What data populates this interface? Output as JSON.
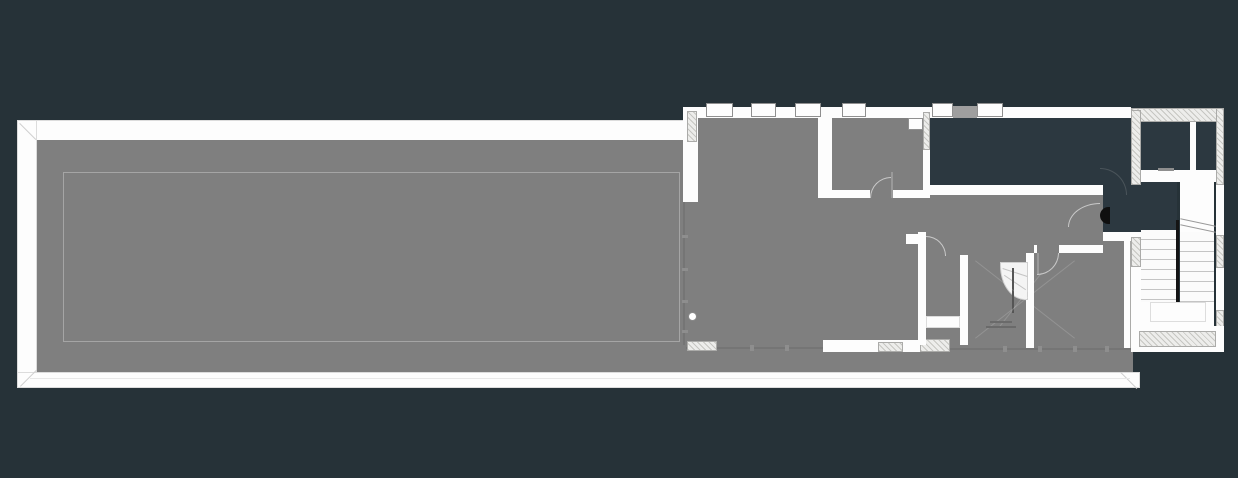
{
  "scene": {
    "type": "architectural floor plan on dark canvas",
    "visible_text": ""
  },
  "colors": {
    "background": "#263238",
    "void": "#2c3840",
    "floor": "#7f7f7f",
    "wall": "#fdfdfd",
    "wall_outline": "#dcdcdc",
    "inner_outline": "#a5a5a5",
    "hatch_fill": "#ededeb",
    "hatch_line": "#c6c6c2",
    "thin_line": "#757575",
    "tread_line": "#c4c4c4",
    "door_arc_light": "#c9c9c9",
    "door_arc_dark": "#4a545a",
    "door_leaf_black": "#0f0f0f",
    "pier_gray": "#9e9e9e"
  },
  "features": [
    "garden-roof-terrace",
    "perimeter-wall",
    "lawn-inner-outline",
    "living-room",
    "bedroom",
    "bathroom",
    "south-east-room",
    "courtyard-void",
    "entry-corridor",
    "top-right-room",
    "u-shaped-stair",
    "winder-stair",
    "window-band",
    "door-swings",
    "glass-facade-line",
    "structural-column"
  ]
}
